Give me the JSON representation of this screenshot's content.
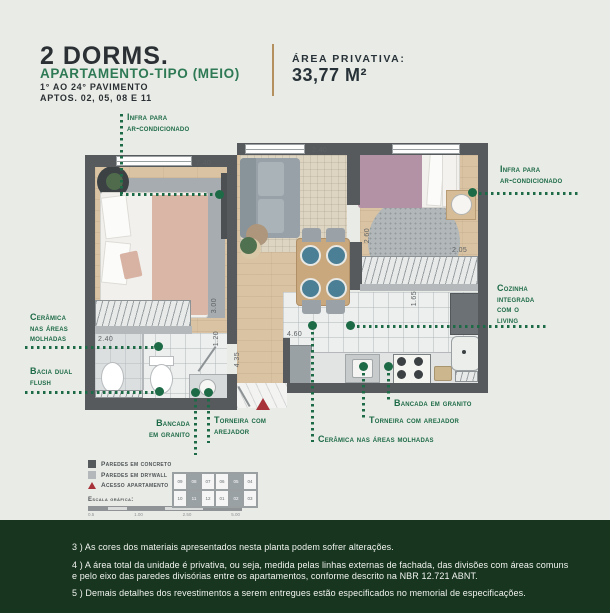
{
  "header": {
    "title": "2 DORMS.",
    "subtitle": "APARTAMENTO-TIPO (MEIO)",
    "floors": "1° AO 24° PAVIMENTO",
    "units": "APTOS. 02, 05, 08 E 11",
    "area_label": "ÁREA PRIVATIVA:",
    "area_value": "33,77 M²",
    "divider_color": "#b3905e"
  },
  "plan": {
    "dimensions": {
      "bedroom1_width": "2.40",
      "living_width": "2.40",
      "bath_width": "2.40",
      "bedroom2_width": "2.05",
      "bedroom2_depth": "2.60",
      "bedroom1_depth": "3.00",
      "bath_depth": "1.20",
      "kitchen_depth": "1.65",
      "kitchen_width": "4.60",
      "hall_depth": "4.35"
    },
    "callouts": {
      "ac_left": "Infra para\nar-condicionado",
      "ac_right": "Infra para\nar-condicionado",
      "ceramica_left": "Cerâmica\nnas áreas\nmolhadas",
      "bacia": "Bacia dual\nflush",
      "bancada_left": "Bancada\nem granito",
      "torneira_left": "Torneira com\narejador",
      "ceramica_bottom": "Cerâmica nas áreas molhadas",
      "cozinha": "Cozinha\nintegrada\ncom o\nliving",
      "torneira_right": "Torneira com arejador",
      "bancada_right": "Bancada em granito"
    },
    "accent_green": "#1d6b46",
    "access_red": "#a8323a",
    "wall_concrete_color": "#565a5d",
    "wall_drywall_color": "#b4b8ba"
  },
  "legend": {
    "items": [
      {
        "key": "concrete",
        "label": "Paredes em concreto"
      },
      {
        "key": "drywall",
        "label": "Paredes em drywall"
      },
      {
        "key": "access",
        "label": "Acesso apartamento"
      }
    ],
    "scale_label": "Escala gráfica:",
    "scale_ticks": [
      "0.5",
      "1.00",
      "2.50",
      "5.00"
    ]
  },
  "keyplan": {
    "top": [
      "09",
      "08",
      "07",
      "06",
      "05",
      "04"
    ],
    "bottom": [
      "10",
      "11",
      "12",
      "01",
      "02",
      "03"
    ],
    "highlighted": [
      "08",
      "05",
      "11",
      "02"
    ]
  },
  "footer": {
    "notes": [
      "3 ) As cores dos materiais apresentados nesta planta podem sofrer alterações.",
      "4 ) A área total da unidade é privativa, ou seja, medida pelas linhas externas de fachada, das divisões com áreas comuns e pelo eixo das paredes divisórias entre os apartamentos, conforme descrito na NBR 12.721 ABNT.",
      "5 ) Demais detalhes dos revestimentos a serem entregues estão especificados no memorial de especificações."
    ],
    "background": "#17351f"
  }
}
